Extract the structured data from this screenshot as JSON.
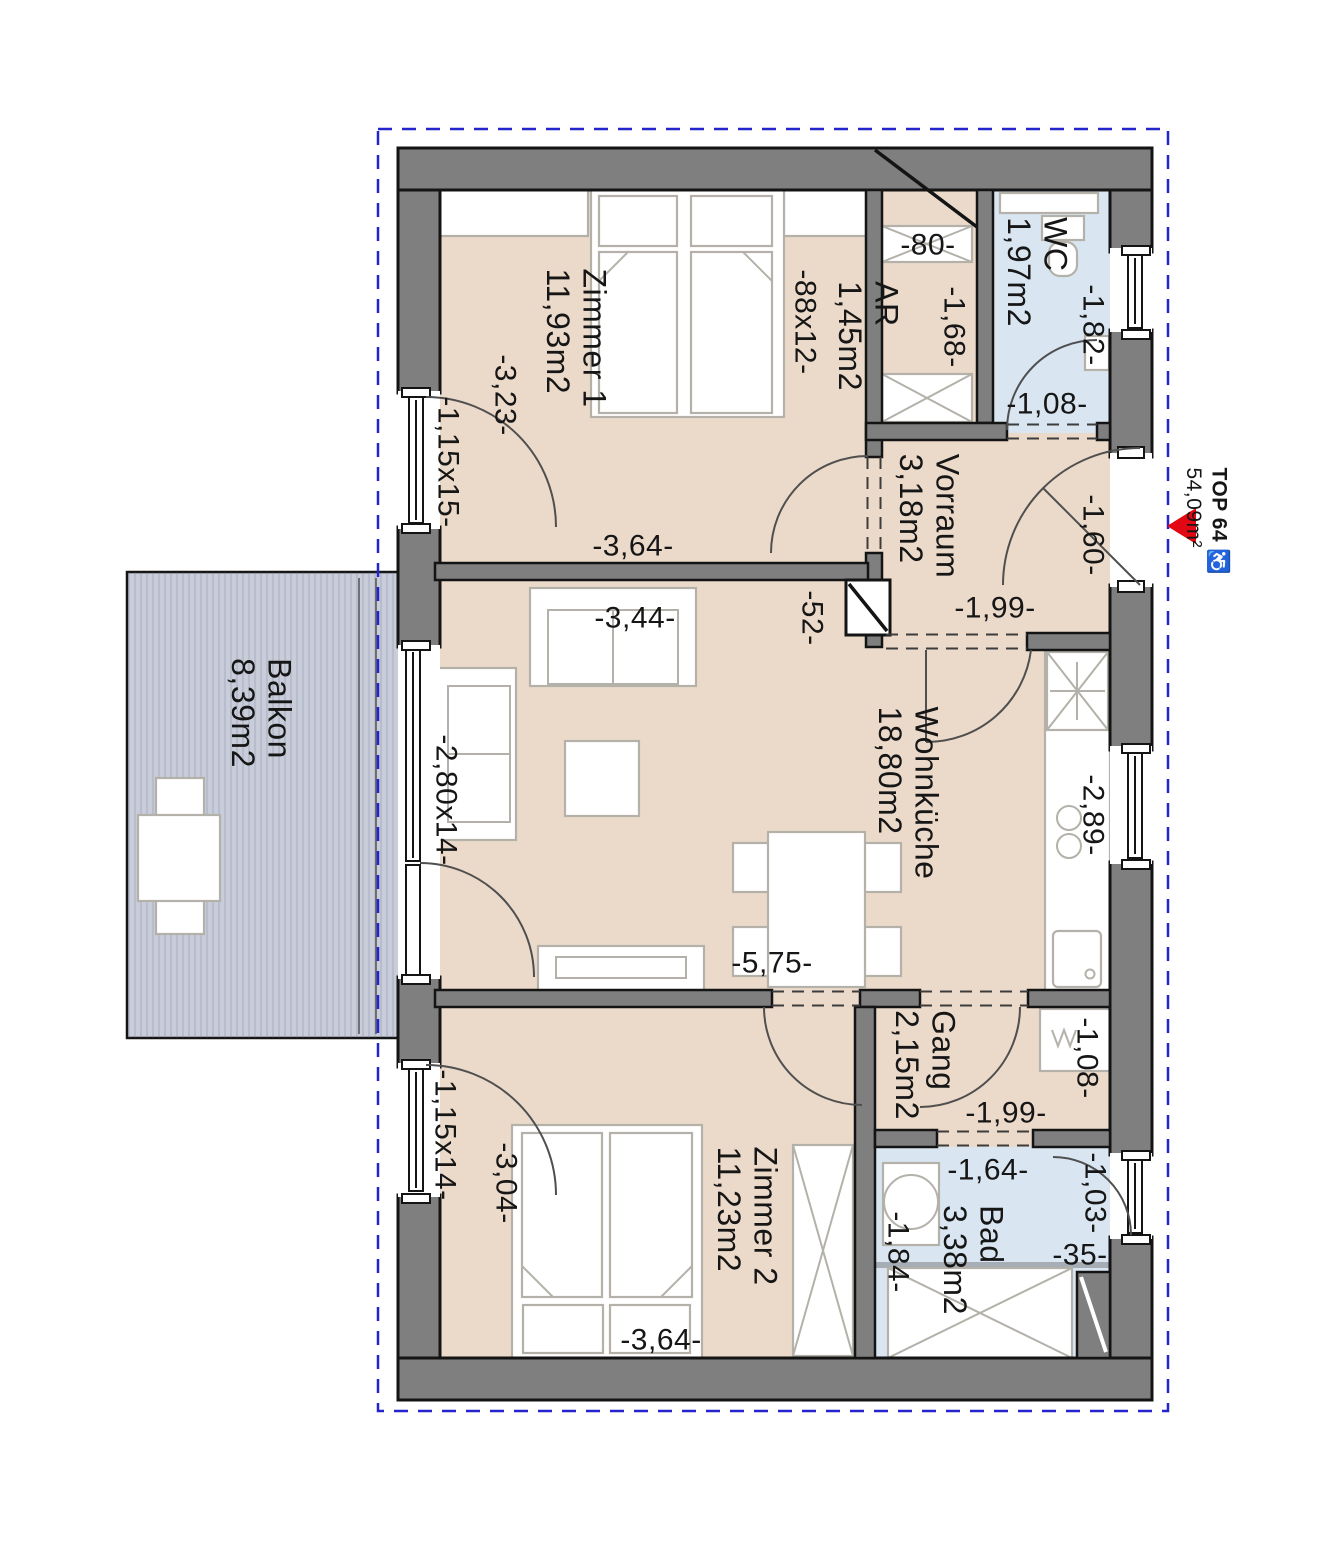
{
  "unit": {
    "name": "TOP 64",
    "accessible_icon": "♿",
    "area": "54,09m²"
  },
  "rooms": {
    "zimmer1": {
      "name": "Zimmer 1",
      "area": "11,93m2"
    },
    "ar": {
      "name": "AR",
      "area": "1,45m2"
    },
    "wc": {
      "name": "WC",
      "area": "1,97m2"
    },
    "vorraum": {
      "name": "Vorraum",
      "area": "3,18m2"
    },
    "wohnkueche": {
      "name": "Wohnküche",
      "area": "18,80m2"
    },
    "balkon": {
      "name": "Balkon",
      "area": "8,39m2"
    },
    "gang": {
      "name": "Gang",
      "area": "2,15m2"
    },
    "zimmer2": {
      "name": "Zimmer 2",
      "area": "11,23m2"
    },
    "bad": {
      "name": "Bad",
      "area": "3,38m2"
    }
  },
  "dims": {
    "z1_width": "-3,23-",
    "z1_window": "-1,15x15-",
    "z1_length": "-3,64-",
    "z1_parapet": "-88x12-",
    "ar_width": "-80-",
    "ar_depth": "-1,68-",
    "wc_depth": "-1,82-",
    "wc_door": "-1,08-",
    "entrance_door": "-1,60-",
    "vorraum_width": "-1,99-",
    "niche": "-52-",
    "sofa": "-3,44-",
    "balcony_door": "-2,80x14-",
    "kitchen": "-2,89-",
    "wk_length": "-5,75-",
    "gang_width": "-1,99-",
    "gang_niche": "-1,08-",
    "z2_window": "-1,15x14-",
    "z2_width": "-3,04-",
    "z2_length": "-3,64-",
    "bad_width": "-1,64-",
    "bad_door": "-1,03-",
    "bad_niche": "-35-",
    "bad_depth": "-1,84-"
  },
  "colors": {
    "floor": "#ebdaca",
    "wet": "#d9e6f1",
    "balcony": "#c8cdd9",
    "wall": "#7f7f7f",
    "boundary": "#2424cd",
    "marker": "#e30613"
  }
}
